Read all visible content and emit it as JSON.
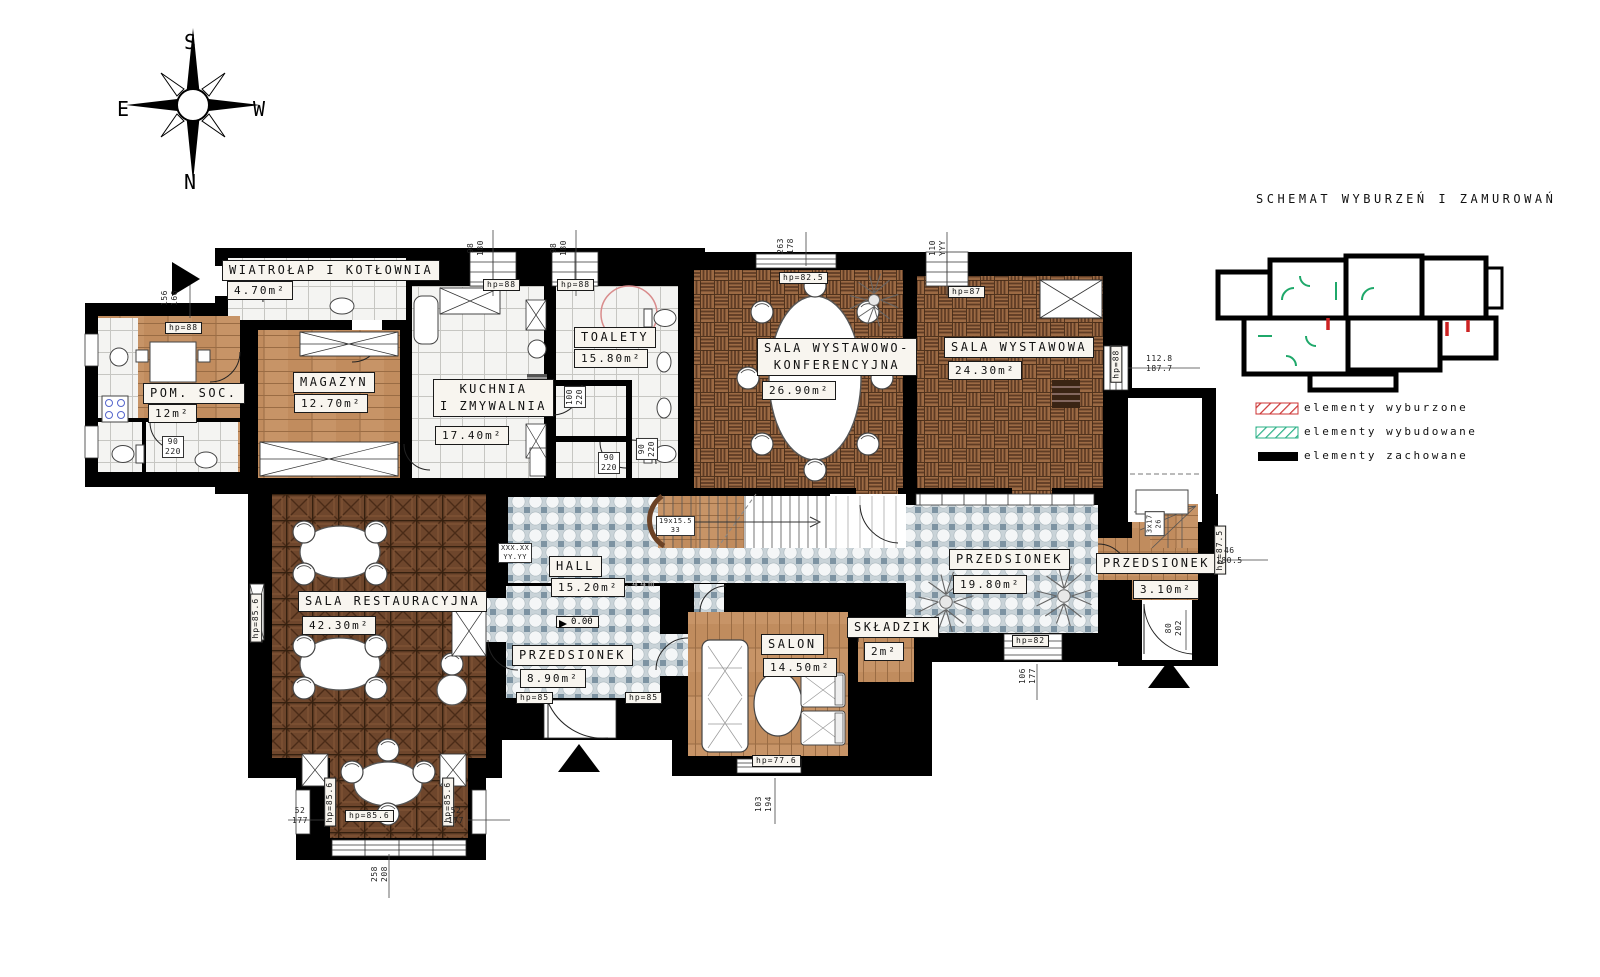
{
  "title": "SCHEMAT WYBURZEŃ I ZAMUROWAŃ",
  "compass": {
    "top": "S",
    "bottom": "N",
    "left": "E",
    "right": "W"
  },
  "rooms": {
    "wiatrolap": {
      "name": "WIATROŁAP I KOTŁOWNIA",
      "area": "4.70m²"
    },
    "pomsoc": {
      "name": "POM. SOC.",
      "area": "12m²"
    },
    "magazyn": {
      "name": "MAGAZYN",
      "area": "12.70m²"
    },
    "kuchnia": {
      "name": "KUCHNIA\nI ZMYWALNIA",
      "area": "17.40m²"
    },
    "toalety": {
      "name": "TOALETY",
      "area": "15.80m²"
    },
    "sala_wk": {
      "name": "SALA WYSTAWOWO-\nKONFERENCYJNA",
      "area": "26.90m²"
    },
    "sala_w": {
      "name": "SALA WYSTAWOWA",
      "area": "24.30m²"
    },
    "sala_rest": {
      "name": "SALA RESTAURACYJNA",
      "area": "42.30m²"
    },
    "hall": {
      "name": "HALL",
      "area": "15.20m²"
    },
    "przedsionek1": {
      "name": "PRZEDSIONEK",
      "area": "8.90m²"
    },
    "przedsionek2": {
      "name": "PRZEDSIONEK",
      "area": "19.80m²"
    },
    "salon": {
      "name": "SALON",
      "area": "14.50m²"
    },
    "skladzik": {
      "name": "SKŁADZIK",
      "area": "2m²"
    },
    "przedsionek3": {
      "name": "PRZEDSIONEK",
      "area": "3.10m²"
    }
  },
  "levels": {
    "zero": "0.00",
    "hall": "-0.44m"
  },
  "stairs": {
    "main": "19x15.5\n33",
    "back": "3x17\n26"
  },
  "hp": {
    "hp88": "hp=88",
    "hp825": "hp=82.5",
    "hp87": "hp=87",
    "hp856": "hp=85.6",
    "hp85": "hp=85",
    "hp82": "hp=82",
    "hp776": "hp=77.6",
    "hp875": "hp=87.5"
  },
  "dims": {
    "w1": "98\n180",
    "w2": "98\n180",
    "mid": "263\n178",
    "top_r": "110\nYYY",
    "sw_right": "112.8\n187.7",
    "pom_top": "156\n166",
    "pom_bath": "90\n220",
    "toa_a": "100\n220",
    "toa_b": "90\n220",
    "toa_c": "90\n220",
    "hall_door": "XXX.XX\nYY.YY",
    "p19_b": "106\n177",
    "salon_b": "103\n194",
    "bay_l": "52\n177",
    "bay_r": "52\n177",
    "bay_b": "258\n208",
    "p3_r": "46\n180.5",
    "p3_door": "80\n202"
  },
  "legend": {
    "items": [
      {
        "label": "elementy wyburzone",
        "color": "#cc3333",
        "style": "hatch"
      },
      {
        "label": "elementy wybudowane",
        "color": "#2bb187",
        "style": "hatch"
      },
      {
        "label": "elementy zachowane",
        "color": "#000000",
        "style": "solid"
      }
    ]
  },
  "colors": {
    "wood": "#c79467",
    "basket_parquet": "#9c6a44",
    "dark_parquet": "#6e462c",
    "floor_tile": "#c9d3d8",
    "walls": "#000000"
  }
}
